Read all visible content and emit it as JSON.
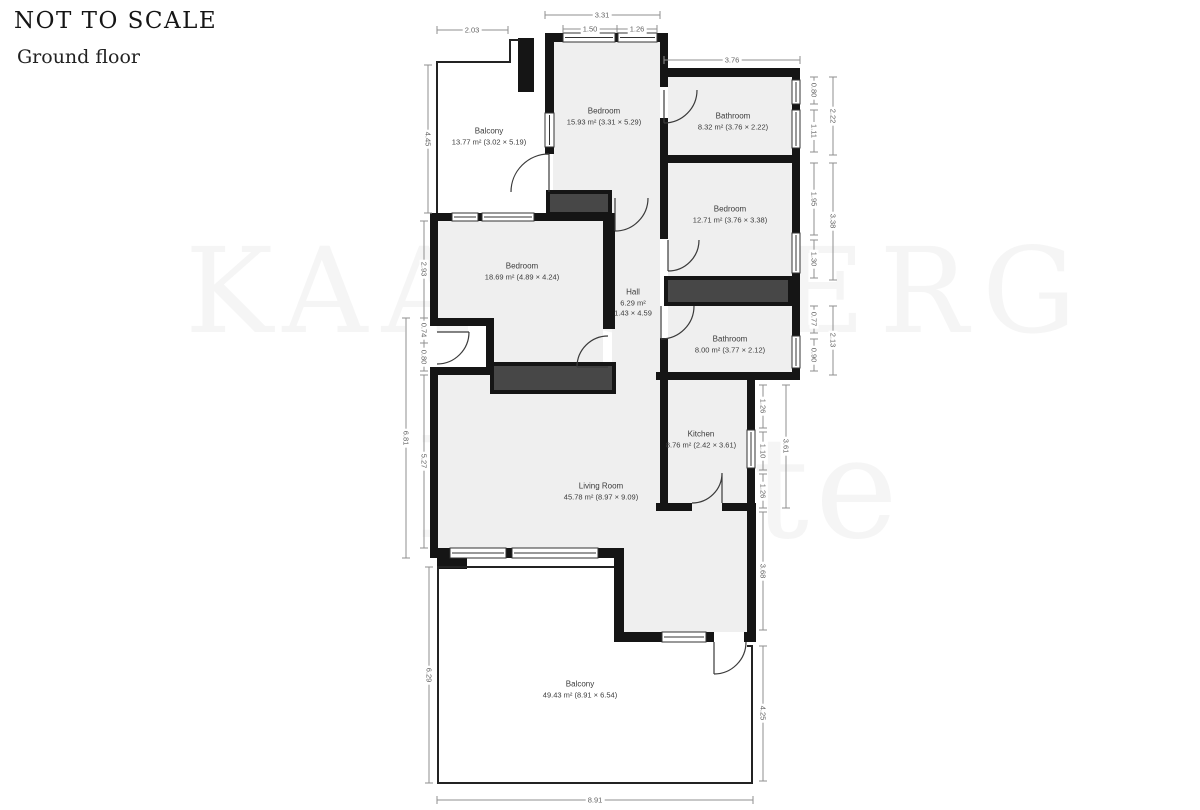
{
  "header": {
    "scale_note": "NOT TO SCALE",
    "floor_label": "Ground floor"
  },
  "watermark": {
    "line1": "KAARSBERG",
    "line2": "Estate"
  },
  "rooms": [
    {
      "name": "Balcony",
      "area": "13.77 m² (3.02 × 5.19)"
    },
    {
      "name": "Bedroom",
      "area": "15.93 m² (3.31 × 5.29)"
    },
    {
      "name": "Bathroom",
      "area": "8.32 m² (3.76 × 2.22)"
    },
    {
      "name": "Bedroom",
      "area": "12.71 m² (3.76 × 3.38)"
    },
    {
      "name": "Bedroom",
      "area": "18.69 m² (4.89 × 4.24)"
    },
    {
      "name": "Hall",
      "area": "6.29 m²",
      "size": "1.43 × 4.59"
    },
    {
      "name": "Bathroom",
      "area": "8.00 m² (3.77 × 2.12)"
    },
    {
      "name": "Kitchen",
      "area": "8.76 m² (2.42 × 3.61)"
    },
    {
      "name": "Living Room",
      "area": "45.78 m² (8.97 × 9.09)"
    },
    {
      "name": "Balcony",
      "area": "49.43 m² (8.91 × 6.54)"
    }
  ],
  "dimensions": {
    "top": [
      "2.03",
      "3.31",
      "1.50",
      "1.26",
      "3.76"
    ],
    "bottom": [
      "8.91"
    ],
    "left": [
      "4.45",
      "2.93",
      "0.74",
      "0.80",
      "6.81",
      "5.27",
      "6.29"
    ],
    "right": [
      "0.80",
      "1.11",
      "2.22",
      "1.95",
      "1.30",
      "3.38",
      "0.77",
      "0.90",
      "2.13",
      "1.26",
      "1.10",
      "1.26",
      "3.61",
      "3.68",
      "4.25"
    ]
  }
}
